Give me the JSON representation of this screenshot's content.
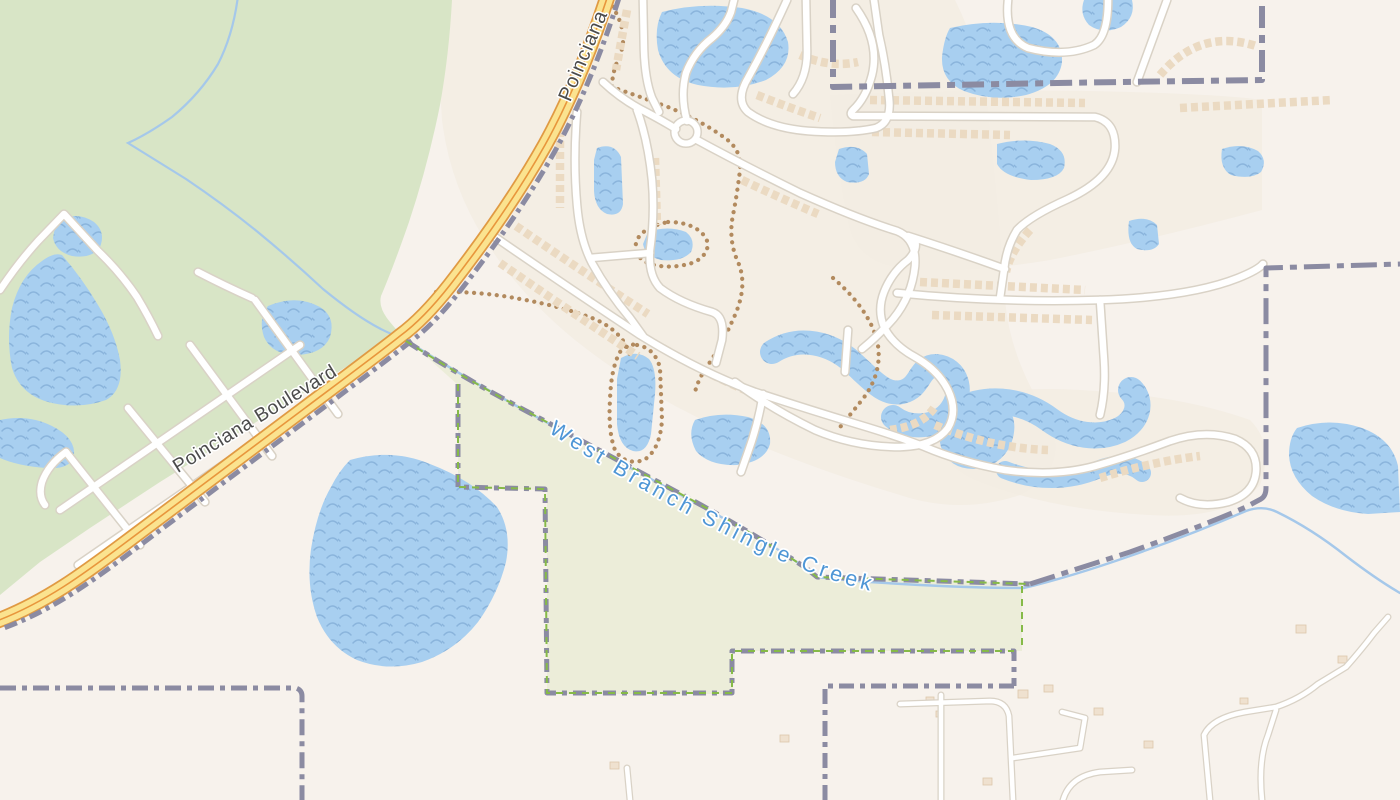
{
  "map": {
    "width": 1400,
    "height": 800,
    "colors": {
      "land": "#f7f2ec",
      "residential": "#f3ece2",
      "forest": "#d8e5c6",
      "reserve": "#ecedd9",
      "water": "#a8cff0",
      "waterWave": "#8ab4dc",
      "stream": "#a5c8ea",
      "roadFill": "#ffffff",
      "roadCasing": "#d9d2c6",
      "blvdFill": "#fbe38f",
      "blvdCasing": "#e09a43",
      "blvdCenter": "#e8963c",
      "boundary": "#8b8ba2",
      "boundaryGreen": "#86ba48",
      "trail": "#b28a5e",
      "buildingStrip": "#ebdac2",
      "buildingFill": "#efe1cf",
      "buildingStroke": "#dcc7ab",
      "labelDark": "#4b4b4b",
      "labelWater": "#4e96d6",
      "halo": "#ffffff"
    },
    "layers": [
      {
        "name": "land-base",
        "kind": "path",
        "style": {
          "fill": "land"
        },
        "paths": [
          "M0 0H1400V800H0Z"
        ]
      },
      {
        "name": "residential-tint",
        "kind": "path",
        "style": {
          "fill": "residential",
          "opacity": 0.8
        },
        "paths": [
          "M440 0 H955 Q985 60 990 130 Q1000 220 1005 300 Q1010 360 1050 420 Q1070 470 1020 495 Q960 515 900 495 Q800 465 720 428 Q640 392 575 340 Q520 295 485 240 Q450 185 442 120 Q438 60 440 0 Z",
          "M830 95 Q1000 88 1130 92 Q1230 95 1262 100 L1262 210 Q1150 240 1050 260 Q960 275 900 268 Q860 262 850 230 Q838 180 830 95 Z",
          "M930 405 Q1000 385 1080 390 Q1180 395 1250 420 Q1275 445 1260 485 Q1230 520 1150 515 Q1050 510 975 480 Q930 460 930 405 Z"
        ]
      },
      {
        "name": "forest-area",
        "kind": "path",
        "style": {
          "fill": "forest"
        },
        "paths": [
          "M0 0 L452 0 Q449 55 440 105 Q428 165 409 222 Q393 268 381 296 Q378 308 390 322 L400 334 L320 383 L240 432 L160 482 L90 528 L40 562 L0 595 Z"
        ]
      },
      {
        "name": "reserve-area",
        "kind": "path",
        "style": {
          "fill": "reserve"
        },
        "paths": [
          "M408 340 L470 378 L545 420 L625 466 L705 510 L772 548 L814 576 L1022 583 L1022 651 L733 651 L733 694 L547 694 L547 490 L458 488 L458 385 Z"
        ]
      },
      {
        "name": "water-bodies",
        "kind": "path",
        "style": {
          "fill": "@water"
        },
        "paths": [
          "M62 255 Q82 278 98 305 Q115 333 120 360 Q124 390 106 400 Q78 410 48 402 Q20 394 12 368 Q6 338 12 308 Q20 276 42 261 Q54 252 62 255 Z",
          "M0 420 Q28 414 52 426 Q76 438 74 456 Q70 470 46 468 Q18 466 0 458 Z",
          "M268 306 Q296 294 320 307 Q336 317 330 337 Q323 354 297 355 Q272 355 264 337 Q258 319 268 306 Z",
          "M56 222 Q76 210 94 222 Q106 232 100 247 Q92 259 72 256 Q56 252 53 238 Z",
          "M350 460 Q392 448 430 464 Q472 480 497 507 Q512 530 506 562 Q498 594 478 622 Q456 650 422 662 Q388 672 357 660 Q329 647 317 617 Q306 586 311 549 Q317 511 331 487 Q339 471 350 460 Z",
          "M662 12 Q700 2 742 8 Q780 15 788 42 Q792 66 766 80 Q734 92 698 85 Q666 78 658 50 Q654 28 662 12 Z",
          "M950 28 Q992 18 1032 27 Q1063 36 1062 62 Q1059 86 1026 95 Q993 102 964 91 Q941 81 942 57 Q944 38 950 28 Z",
          "M597 148 Q614 142 621 157 L623 204 Q621 217 607 214 Q595 209 594 191 L594 160 Z",
          "M648 232 Q668 225 686 232 Q696 240 691 252 Q682 262 661 260 Q645 256 643 244 Z",
          "M621 358 Q637 349 649 359 Q657 369 655 394 L651 434 Q647 454 633 451 Q619 447 617 424 L617 379 Z",
          "M695 420 Q720 411 748 417 Q772 424 770 444 Q765 462 737 465 Q709 466 696 451 Q687 434 695 420 Z",
          "M997 144 Q1024 137 1050 144 Q1068 151 1064 168 Q1058 180 1031 180 Q1004 177 997 164 Z",
          "M839 149 Q857 143 867 154 L869 174 Q865 185 847 182 Q835 177 835 162 Z",
          "M1222 149 Q1242 142 1258 151 Q1268 160 1261 172 Q1251 180 1231 175 Q1219 168 1222 149 Z",
          "M1129 221 Q1147 215 1157 225 L1159 244 Q1153 253 1137 249 Q1126 243 1129 221 Z",
          "M1297 428 Q1330 417 1362 428 Q1392 439 1398 466 L1400 512 L1368 514 Q1335 512 1312 496 Q1290 478 1289 455 Q1289 438 1297 428 Z",
          "M1084 0 L1132 0 Q1136 17 1121 27 Q1103 35 1089 25 Q1079 14 1084 0 Z",
          "M950 397 Q984 387 1005 404 Q1020 420 1011 444 Q1001 467 974 469 Q949 469 941 447 Q934 421 950 397 Z"
        ]
      },
      {
        "name": "water-channels",
        "kind": "path",
        "style": {
          "stroke": "@water",
          "fill": "none",
          "cap": "round",
          "join": "round",
          "width": 24
        },
        "paths": [
          {
            "d": "M772 352 C800 334 832 344 852 362 C870 378 884 396 902 392 C922 387 918 366 936 366 C958 368 964 392 951 410 C938 428 910 430 893 417",
            "w": 24
          },
          {
            "d": "M958 410 C992 394 1026 402 1050 420 C1072 436 1098 440 1120 430 C1138 421 1143 402 1131 390",
            "w": 26
          },
          {
            "d": "M1005 470 C1035 482 1068 482 1097 470 C1116 462 1131 463 1142 473",
            "w": 18
          }
        ]
      },
      {
        "name": "forest-stream",
        "kind": "path",
        "style": {
          "stroke": "stream",
          "fill": "none",
          "width": 2.2,
          "cap": "round"
        },
        "paths": [
          "M238 -4 Q233 35 218 64 Q200 94 172 117 Q148 134 128 143 Q152 158 186 179 Q226 206 259 233 Q293 261 323 289 Q356 316 379 328 Q392 335 401 337"
        ]
      },
      {
        "name": "shingle-creek-line",
        "kind": "path",
        "style": {
          "stroke": "stream",
          "fill": "none",
          "width": 2.4,
          "cap": "round"
        },
        "paths": [
          "M401 337 Q455 372 522 409 Q592 447 662 485 Q732 522 782 552 Q806 568 817 577 Q860 582 920 585 Q980 588 1024 588 Q1070 577 1130 556 Q1190 535 1246 511 Q1263 505 1277 512 Q1312 529 1346 556 Q1376 579 1400 593"
        ]
      },
      {
        "name": "foot-trails",
        "kind": "path",
        "style": {
          "stroke": "trail",
          "fill": "none",
          "width": 4.2,
          "dash": "0.1 7.5",
          "cap": "round"
        },
        "paths": [
          "M436 292 Q480 291 520 299 Q560 306 592 318 Q615 327 626 345 L631 357",
          "M608 0 Q630 30 620 55 Q612 72 612 87 Q635 95 668 107 Q700 120 725 138 Q742 150 740 170 Q737 195 733 215 Q728 240 738 262 Q748 285 735 315 Q722 345 706 368 Q698 380 695 392",
          "M668 222 Q695 222 706 238 Q712 252 695 262 Q672 270 650 264 Q634 258 636 243 Q640 228 668 222 Z",
          "M637 345 Q655 348 660 368 L662 420 Q660 450 644 460 Q625 466 615 450 Q608 432 610 400 Q611 368 620 352 Q627 343 637 345 Z",
          "M833 278 Q868 308 877 340 Q884 372 862 400 Q846 420 836 432"
        ]
      },
      {
        "name": "building-rows",
        "kind": "path",
        "style": {
          "stroke": "buildingStrip",
          "fill": "none",
          "width": 8.5,
          "dash": "7 4"
        },
        "paths": [
          "M500 263 Q565 308 638 356",
          "M516 226 Q580 270 648 314",
          "M663 348 Q720 382 776 402",
          "M560 130 L560 208",
          "M627 10 Q621 42 616 70",
          "M757 95 Q790 108 820 118",
          "M655 158 L657 225",
          "M742 180 Q780 198 818 214",
          "M870 100 L1085 103",
          "M872 132 L1010 135",
          "M920 282 L1085 290",
          "M932 315 L1092 320",
          "M1160 75 Q1200 28 1256 46",
          "M935 425 Q990 448 1048 450",
          "M1100 478 Q1150 462 1200 456",
          "M800 55 Q830 68 858 62",
          "M890 430 Q922 426 934 408",
          "M1180 108 L1332 100",
          "M1030 230 Q1010 252 1006 272"
        ]
      },
      {
        "name": "rural-buildings",
        "kind": "rects",
        "style": {
          "fill": "buildingFill",
          "stroke": "buildingStroke",
          "width": 0.8
        },
        "rects": [
          [
            1018,
            690,
            10,
            8
          ],
          [
            1044,
            685,
            9,
            7
          ],
          [
            1094,
            708,
            9,
            7
          ],
          [
            1144,
            741,
            9,
            7
          ],
          [
            1296,
            625,
            10,
            8
          ],
          [
            1338,
            656,
            9,
            7
          ],
          [
            780,
            735,
            9,
            7
          ],
          [
            926,
            697,
            8,
            7
          ],
          [
            936,
            711,
            8,
            6
          ],
          [
            610,
            762,
            9,
            7
          ],
          [
            983,
            778,
            9,
            7
          ],
          [
            1240,
            698,
            8,
            6
          ]
        ]
      },
      {
        "name": "road-casings",
        "kind": "path",
        "style": {
          "stroke": "roadCasing",
          "fill": "none",
          "width": 9.5,
          "cap": "round",
          "join": "round"
        },
        "circles": [
          {
            "cx": 686,
            "cy": 132,
            "r": 11.5,
            "w": 9
          }
        ],
        "paths": [
          "M603 82 Q622 100 646 112 Q663 121 676 129",
          "M687 121 Q680 96 686 73 Q694 52 712 38 Q726 26 731 12 L734 0",
          "M643 0 L644 50 Q645 80 652 98 L659 112",
          "M697 140 Q745 166 800 193 Q858 219 897 231 Q917 239 915 266 Q912 296 893 319 Q878 336 862 349",
          "M735 382 Q770 408 815 430 Q855 447 900 447 Q935 446 948 428 Q958 411 948 390 Q938 370 915 357 Q893 345 884 327 Q877 310 884 292 Q892 272 908 260 Q918 250 915 240",
          "M492 235 Q560 282 640 335 Q700 372 755 392 Q810 410 860 425 Q900 437 925 447 Q960 462 1005 470 Q1055 477 1095 466 Q1130 456 1170 441 Q1205 429 1235 439 Q1258 449 1256 472 Q1254 494 1228 502 Q1200 509 1180 498",
          "M577 112 Q573 160 577 205 Q580 240 592 263 Q608 292 630 318 L643 336",
          "M637 110 Q648 140 652 180 Q655 215 650 250 Q648 275 660 288 Q680 303 712 312 Q725 316 722 340 L716 363",
          "M590 258 L650 253",
          "M763 394 Q758 425 748 452 L741 472",
          "M806 0 L807 52 Q807 78 793 94",
          "M787 0 Q768 42 748 78 Q735 100 748 112 Q770 128 808 131 Q850 134 876 128 Q892 122 889 98 Q886 65 879 35 L874 0",
          "M848 330 L845 372",
          "M908 236 Q955 251 1005 269",
          "M856 8 Q880 42 872 75 Q866 98 853 110 Q849 114 853 116 L1095 117 Q1116 122 1115 148 Q1113 178 1068 199 Q1030 216 1017 230 Q1006 248 1004 270 L1000 298",
          "M1008 0 Q1004 38 1028 48 Q1066 58 1094 45 Q1108 36 1108 0",
          "M1167 0 L1137 82",
          "M897 293 Q1000 303 1100 300 Q1190 297 1238 278 Q1258 270 1263 264",
          "M1100 300 L1104 360 Q1106 390 1100 415",
          "M0 290 Q18 263 38 241 L64 214 L98 251 Q120 272 137 297 Q149 317 158 336",
          "M198 272 Q225 286 252 298",
          "M300 345 Q180 428 60 510",
          "M332 390 Q205 478 78 565",
          "M255 300 L338 414",
          "M190 345 L272 456",
          "M128 408 L205 502",
          "M66 452 L140 545",
          "M66 452 Q48 465 42 482 Q38 496 45 505",
          {
            "d": "M941 695 L941 800",
            "w": 7
          },
          {
            "d": "M900 704 L990 701 Q1006 701 1009 716 L1013 800",
            "w": 7
          },
          {
            "d": "M1013 758 L1080 748 L1085 718 L1062 712",
            "w": 7
          },
          {
            "d": "M1210 800 L1204 735 Q1212 718 1245 712 L1276 707 Q1300 699 1318 684 L1346 667 Q1362 649 1374 633 L1388 617",
            "w": 7
          },
          {
            "d": "M1063 800 Q1070 776 1100 772 L1132 770",
            "w": 7
          },
          {
            "d": "M1262 800 Q1258 760 1268 735 L1276 710",
            "w": 7
          },
          {
            "d": "M630 800 L627 768",
            "w": 7
          }
        ]
      },
      {
        "name": "road-fills",
        "kind": "path",
        "style": {
          "stroke": "roadFill",
          "fill": "none",
          "width": 6.5,
          "cap": "round",
          "join": "round"
        },
        "circles": [
          {
            "cx": 686,
            "cy": 132,
            "r": 11.5,
            "w": 6
          }
        ],
        "paths": [
          "M603 82 Q622 100 646 112 Q663 121 676 129",
          "M687 121 Q680 96 686 73 Q694 52 712 38 Q726 26 731 12 L734 0",
          "M643 0 L644 50 Q645 80 652 98 L659 112",
          "M697 140 Q745 166 800 193 Q858 219 897 231 Q917 239 915 266 Q912 296 893 319 Q878 336 862 349",
          "M735 382 Q770 408 815 430 Q855 447 900 447 Q935 446 948 428 Q958 411 948 390 Q938 370 915 357 Q893 345 884 327 Q877 310 884 292 Q892 272 908 260 Q918 250 915 240",
          "M492 235 Q560 282 640 335 Q700 372 755 392 Q810 410 860 425 Q900 437 925 447 Q960 462 1005 470 Q1055 477 1095 466 Q1130 456 1170 441 Q1205 429 1235 439 Q1258 449 1256 472 Q1254 494 1228 502 Q1200 509 1180 498",
          "M577 112 Q573 160 577 205 Q580 240 592 263 Q608 292 630 318 L643 336",
          "M637 110 Q648 140 652 180 Q655 215 650 250 Q648 275 660 288 Q680 303 712 312 Q725 316 722 340 L716 363",
          "M590 258 L650 253",
          "M763 394 Q758 425 748 452 L741 472",
          "M806 0 L807 52 Q807 78 793 94",
          "M787 0 Q768 42 748 78 Q735 100 748 112 Q770 128 808 131 Q850 134 876 128 Q892 122 889 98 Q886 65 879 35 L874 0",
          "M848 330 L845 372",
          "M908 236 Q955 251 1005 269",
          "M856 8 Q880 42 872 75 Q866 98 853 110 Q849 114 853 116 L1095 117 Q1116 122 1115 148 Q1113 178 1068 199 Q1030 216 1017 230 Q1006 248 1004 270 L1000 298",
          "M1008 0 Q1004 38 1028 48 Q1066 58 1094 45 Q1108 36 1108 0",
          "M1167 0 L1137 82",
          "M897 293 Q1000 303 1100 300 Q1190 297 1238 278 Q1258 270 1263 264",
          "M1100 300 L1104 360 Q1106 390 1100 415",
          "M0 290 Q18 263 38 241 L64 214 L98 251 Q120 272 137 297 Q149 317 158 336",
          "M198 272 Q225 286 252 298",
          "M300 345 Q180 428 60 510",
          "M332 390 Q205 478 78 565",
          "M255 300 L338 414",
          "M190 345 L272 456",
          "M128 408 L205 502",
          "M66 452 L140 545",
          "M66 452 Q48 465 42 482 Q38 496 45 505",
          {
            "d": "M941 695 L941 800",
            "w": 4.5
          },
          {
            "d": "M900 704 L990 701 Q1006 701 1009 716 L1013 800",
            "w": 4.5
          },
          {
            "d": "M1013 758 L1080 748 L1085 718 L1062 712",
            "w": 4.5
          },
          {
            "d": "M1210 800 L1204 735 Q1212 718 1245 712 L1276 707 Q1300 699 1318 684 L1346 667 Q1362 649 1374 633 L1388 617",
            "w": 4.5
          },
          {
            "d": "M1063 800 Q1070 776 1100 772 L1132 770",
            "w": 4.5
          },
          {
            "d": "M1262 800 Q1258 760 1268 735 L1276 710",
            "w": 4.5
          },
          {
            "d": "M630 800 L627 768",
            "w": 4.5
          }
        ]
      },
      {
        "name": "boulevard-casing",
        "kind": "path",
        "style": {
          "stroke": "blvdCasing",
          "fill": "none",
          "width": 16,
          "cap": "round"
        },
        "paths": [
          "M609 -8 C592 45 570 100 545 145 C518 193 485 240 450 285 C432 308 415 325 400 336 C380 352 345 378 305 408 C245 453 185 498 125 543 C85 573 45 603 -6 622"
        ]
      },
      {
        "name": "boulevard-fill",
        "kind": "path",
        "style": {
          "stroke": "blvdFill",
          "fill": "none",
          "width": 12.5,
          "cap": "round"
        },
        "paths": [
          "M609 -8 C592 45 570 100 545 145 C518 193 485 240 450 285 C432 308 415 325 400 336 C380 352 345 378 305 408 C245 453 185 498 125 543 C85 573 45 603 -6 622"
        ]
      },
      {
        "name": "boulevard-centerline",
        "kind": "path",
        "style": {
          "stroke": "blvdCenter",
          "fill": "none",
          "width": 1.6
        },
        "paths": [
          "M609 -8 C592 45 570 100 545 145 C518 193 485 240 450 285 C432 308 415 325 400 336 C380 352 345 378 305 408 C245 453 185 498 125 543 C85 573 45 603 -6 622"
        ]
      },
      {
        "name": "admin-boundaries",
        "kind": "path",
        "style": {
          "stroke": "boundary",
          "fill": "none",
          "width": 5,
          "dash": "13 5 4 5",
          "join": "round"
        },
        "paths": [
          {
            "d": "M619 -2 C602 51 580 106 555 151 C528 199 495 246 460 291 C442 314 425 331 410 342 C390 358 355 384 315 414 C255 459 195 504 135 549 C95 579 55 609 4 628",
            "dash": "13 5 4 5"
          },
          {
            "d": "M406 341 Q460 376 530 413 Q610 456 690 499 Q755 534 806 568 L817 577 L1030 584",
            "dash": "15 6 6 6"
          },
          {
            "d": "M1030 584 L1130 552 Q1200 527 1246 507 L1261 499 Q1266 496 1266 488 L1266 268 L1400 264",
            "dash": "26 7 7 7"
          },
          {
            "d": "M833 -4 L833 87 Q1000 84 1120 82 L1262 80 L1262 -4",
            "dash": "22 7 8 7",
            "w": 6
          },
          {
            "d": "M458 384 L458 487 L545 489 L547 693 L732 693 L732 651 L1014 651 L1014 686",
            "dash": "13 6 5 6"
          },
          {
            "d": "M1014 686 L825 686 L825 800",
            "dash": "15 6 5 6"
          },
          {
            "d": "M0 688 L296 688 Q302 690 302 696 L302 800",
            "dash": "16 6 5 6"
          }
        ]
      },
      {
        "name": "protected-area-boundaries",
        "kind": "path",
        "style": {
          "stroke": "boundaryGreen",
          "fill": "none",
          "width": 2,
          "dash": "7 6"
        },
        "paths": [
          "M406 341 Q460 376 530 413 Q610 456 690 499 Q755 534 806 568 L817 577 L1030 584",
          "M458 384 L458 487 L545 489 L547 693 L732 693 L732 651 L1014 651",
          "M1022 586 L1022 650"
        ]
      }
    ],
    "labels": [
      {
        "name": "road-label-poinciana",
        "text": "Poinciana",
        "x": 589,
        "y": 58,
        "rotate": -67,
        "size": 20,
        "color": "labelDark",
        "spacing": 1,
        "halo": 3
      },
      {
        "name": "road-label-poinciana-boulevard",
        "text": "Poinciana Boulevard",
        "x": 258,
        "y": 424,
        "rotate": -31.5,
        "size": 19.5,
        "color": "labelDark",
        "spacing": 0.5,
        "halo": 3
      },
      {
        "name": "water-label-west-branch-shingle-creek",
        "text": "West Branch Shingle Creek",
        "pathD": "M548 432 Q650 497 748 546 Q830 585 900 597 Q940 603 990 596",
        "size": 21.5,
        "color": "labelWater",
        "spacing": 4,
        "halo": 3.5
      }
    ]
  }
}
